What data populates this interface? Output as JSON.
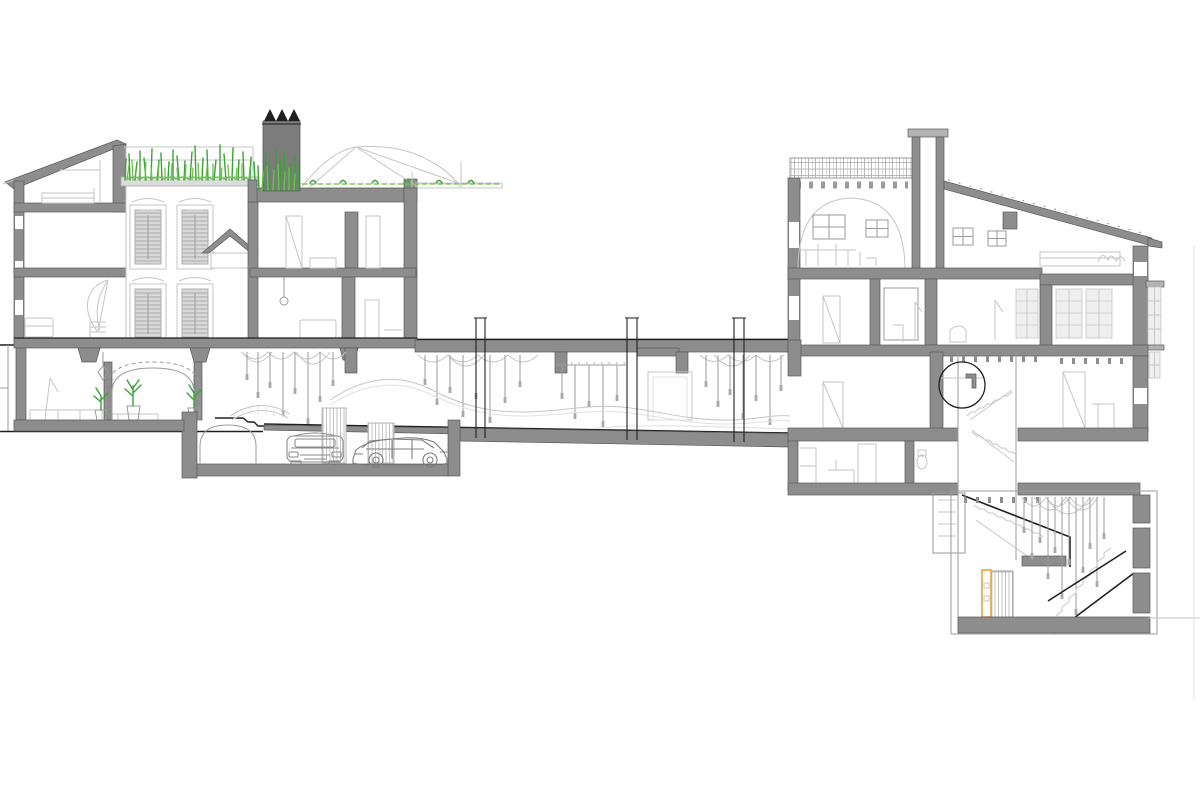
{
  "meta": {
    "title": "Architectural long section drawing",
    "drawing_type": "building cross-section / sectional elevation",
    "visible_text": "none"
  },
  "palette": {
    "bg": "#ffffff",
    "poche": "#8d8d8d",
    "poche-dark": "#7c7c7c",
    "cap": "#b3b3b3",
    "ink": "#1f1f1f",
    "ink2": "#5a5a5a",
    "line": "#9b9b9b",
    "line-light": "#c6c6c6",
    "line-faint": "#e0e0e0",
    "green": "#3aa335",
    "green-light": "#6cc24a",
    "orange": "#e8a33c",
    "glass-fill": "#efefef"
  },
  "elements": {
    "left_building": "four-storey townhouse cut in section, mono-pitch roof, roof garden with tall grasses",
    "chimney": "dark grey chimney stack with 3 black triangular caps",
    "canopy": "tensile sail canopy over roof terrace",
    "facade": "ornate street facade in elevation with 4 shuttered windows",
    "gallery_wing": "long single-storey wing with pendant lights, swag garlands and undulating ramp",
    "garage": "basement garage with two cars under a vaulted slab",
    "right_building": "two-storey house with tiled flat roof, tower and mono-pitch roof",
    "stair_shaft": "vertical stair shaft descending to sunken hall",
    "basement_hall": "double-height sunken hall with cascading chandelier and stair",
    "detail_circle": "circular detail callout on wall junction",
    "orange_element": "orange highlighted door/panel in basement"
  },
  "counts": {
    "chimney_caps": 3,
    "potted_plants": 3,
    "cars": 2,
    "facade_windows": 4,
    "section_break_column_pairs": 3
  }
}
